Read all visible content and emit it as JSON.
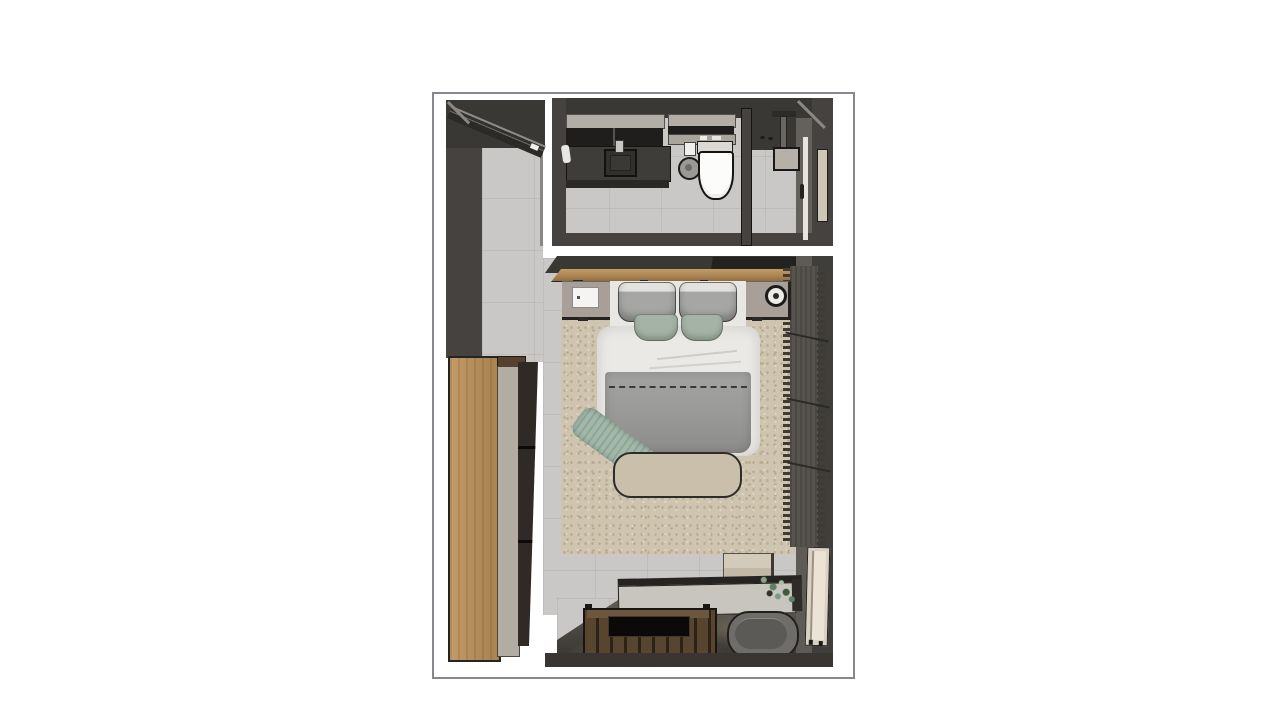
{
  "scene": {
    "type": "3d-floor-plan-top-view",
    "rooms": [
      {
        "name": "bathroom",
        "items": [
          "vanity-cabinet",
          "sink",
          "faucet",
          "upper-cabinet",
          "towel-shelf",
          "toilet",
          "toilet-paper",
          "waste-bin",
          "shower-column",
          "shower-partition",
          "bathroom-door",
          "wall-panel",
          "floor-drain"
        ]
      },
      {
        "name": "entry-hall",
        "items": [
          "entry-door",
          "tiled-floor"
        ]
      },
      {
        "name": "bedroom",
        "items": [
          "double-bed",
          "pillow-left",
          "pillow-right",
          "accent-pillow-left",
          "accent-pillow-right",
          "duvet",
          "foot-blanket",
          "throw-blanket",
          "bed-end-bench",
          "nightstand-left",
          "notepad",
          "nightstand-right",
          "speaker",
          "headboard-shelf",
          "wall-tv-niche",
          "area-rug",
          "wardrobe",
          "open-shelving",
          "curtain",
          "console-table",
          "potted-plant",
          "slatted-mat",
          "floor-tray",
          "pouf",
          "leaning-mirror",
          "side-stool"
        ]
      }
    ]
  },
  "colors": {
    "frame": "#87878d",
    "wall": "#45423f",
    "wallDark": "#3a3835",
    "wallFace": "#64615d",
    "floor": "#c9c8c6",
    "floorBand": "#504d49",
    "rug": "#cec4af",
    "wood": "#b98f5c",
    "shelfWood": "#ad8655",
    "matWood": "#54422e",
    "duvet": "#ebe9e5",
    "pillow": "#a6a6a4",
    "sage": "#a4b3a5",
    "blanket": "#999997",
    "bench": "#c9bfab",
    "stand": "#a8a098",
    "counter": "#3f3d39",
    "curtain": "#56524c",
    "console": "#c8c5bf",
    "pouf": "#6f6d69",
    "mirror": "#d8d0c1",
    "stool": "#ccc2b0",
    "plant": "#7d9b80",
    "ink": "#1d1c1a"
  }
}
